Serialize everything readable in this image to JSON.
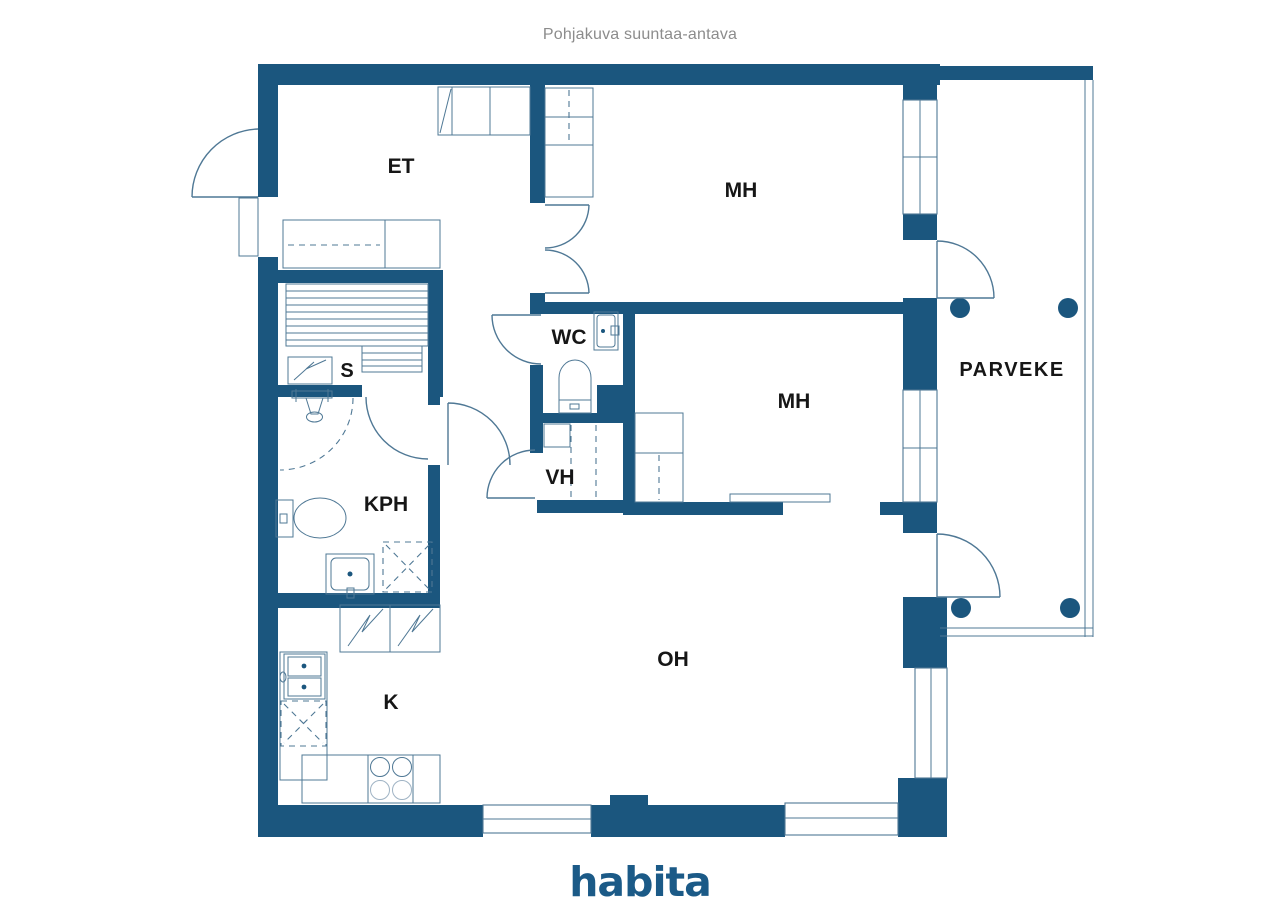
{
  "page": {
    "title": "Pohjakuva suuntaa-antava",
    "brand": "habita"
  },
  "floorplan": {
    "room_labels": [
      {
        "id": "et",
        "label": "ET"
      },
      {
        "id": "mh-top",
        "label": "MH"
      },
      {
        "id": "wc",
        "label": "WC"
      },
      {
        "id": "mh-middle",
        "label": "MH"
      },
      {
        "id": "parveke",
        "label": "PARVEKE"
      },
      {
        "id": "sauna",
        "label": "S"
      },
      {
        "id": "kph",
        "label": "KPH"
      },
      {
        "id": "vh",
        "label": "VH"
      },
      {
        "id": "oh",
        "label": "OH"
      },
      {
        "id": "kitchen",
        "label": "K"
      }
    ],
    "colors": {
      "wall_blue": "#1B567E",
      "line_blue_gray": "#4F7895",
      "label_dark": "#161616",
      "title_gray": "#8C8C8C",
      "brand_blue": "#1B5A87",
      "background": "#FFFFFF"
    }
  }
}
